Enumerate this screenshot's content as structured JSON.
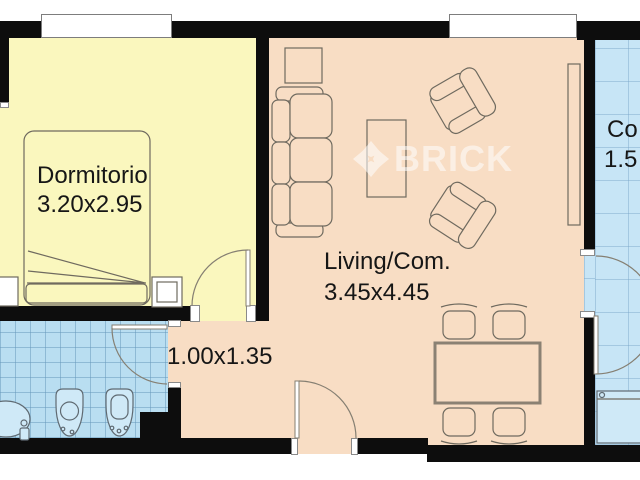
{
  "watermark": {
    "brand": "BRICK",
    "logo_icon": "brick-pinwheel-logo"
  },
  "rooms": {
    "dormitorio": {
      "name": "Dormitorio",
      "size": "3.20x2.95"
    },
    "living": {
      "name": "Living/Com.",
      "size": "3.45x4.45"
    },
    "hall": {
      "size": "1.00x1.35"
    },
    "cocina": {
      "name_clipped": "Co",
      "size_clipped": "1.5"
    }
  },
  "colors": {
    "bedroom_floor": "#faf7be",
    "living_floor": "#f8ddc4",
    "bathroom_floor": "#b9def1",
    "kitchen_floor": "#c7e5f6",
    "wall": "#0d0d0d",
    "furniture_stroke": "#6f6a5f",
    "watermark": "#ffffff"
  },
  "furniture": [
    "double-bed",
    "nightstand",
    "sofa-3-seat",
    "armchair",
    "coffee-table",
    "side-table",
    "bookshelf",
    "dining-table",
    "dining-chair",
    "toilet",
    "bidet",
    "sink",
    "kitchen-counter"
  ],
  "openings": [
    "bedroom-window",
    "living-window",
    "bedroom-door",
    "bathroom-door",
    "entry-door",
    "kitchen-door"
  ]
}
